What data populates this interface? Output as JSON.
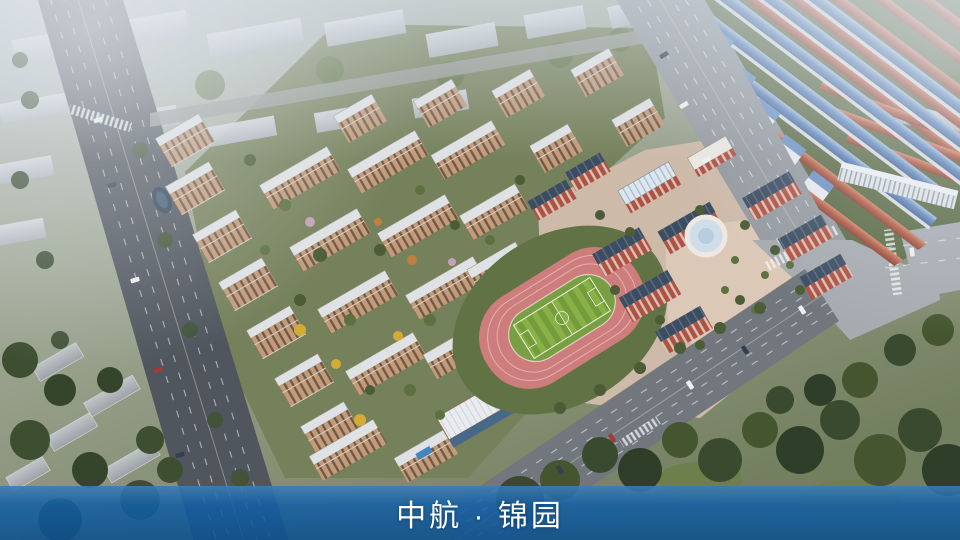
{
  "banner": {
    "title": "中航 · 锦园"
  },
  "theme": {
    "banner_blue": "#1160a6",
    "banner_text": "#ffffff"
  },
  "scene": {
    "type": "aerial-masterplan-rendering",
    "areas": [
      {
        "name": "context-city-blocks",
        "color": "#c6cdd3"
      },
      {
        "name": "residential-apartment-buildings",
        "facade_color": "#c29b7b",
        "roof_color": "#dfe2e4"
      },
      {
        "name": "school-campus",
        "brick_color": "#ad5344",
        "roof_color": "#3d4d61"
      },
      {
        "name": "running-track",
        "track_color": "#cd7e7c",
        "field_color": "#7da344"
      },
      {
        "name": "townhouse-rows-blue-roof",
        "color": "#6189bd"
      },
      {
        "name": "townhouse-rows-red-roof",
        "color": "#b25c46"
      },
      {
        "name": "roads",
        "color": "#787e84"
      },
      {
        "name": "trees",
        "color": "#46572f"
      }
    ]
  }
}
